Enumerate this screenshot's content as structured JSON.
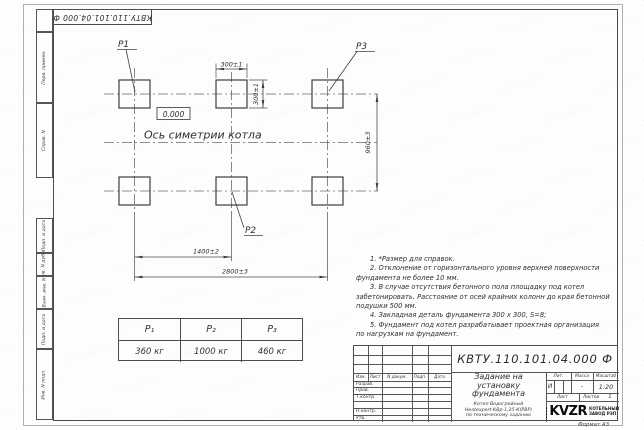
{
  "page": {
    "format_note": "Формат А3",
    "watermark_text": "··············"
  },
  "frame": {
    "top_stamp": "КВТУ.110.101.04.000  Ф",
    "left_margin_labels": [
      "Перв. примен.",
      "Справ. N",
      "Подп. и дата",
      "Инв. N дубл.",
      "Взам. инв. N",
      "Подп. и дата",
      "Инв. N подл."
    ]
  },
  "plan": {
    "pad_labels": {
      "p1": "P1",
      "p2": "P2",
      "p3": "P3"
    },
    "elevation_mark": "0.000",
    "axis_caption": "Ось симетрии котла",
    "dims": {
      "pad_width": "300±1",
      "pad_height": "300±1",
      "row_pitch": "960±3",
      "mid_pitch": "1400±2",
      "full_pitch": "2800±3"
    }
  },
  "load_table": {
    "headers": [
      "P₁",
      "P₂",
      "P₃"
    ],
    "values": [
      "360 кг",
      "1000 кг",
      "460 кг"
    ]
  },
  "notes": {
    "lines": [
      "1. *Размер для справок.",
      "2. Отклонение от горизонтального уровня верхней поверхности",
      "фундамента не более 10 мм.",
      "3. В случае отсутствия бетонного пола площадку под котел",
      "забетонировать. Расстояние от осей крайних колонн до края бетонной",
      "подушки 500 мм.",
      "4. Закладная деталь фундамента  300 x 300, S=8;",
      "5. Фундамент под котел разрабатывает проектная организация",
      "по нагрузкам на фундамент."
    ]
  },
  "title_block": {
    "designation": "КВТУ.110.101.04.000  Ф",
    "doc_title_lines": [
      "Задание на",
      "установку",
      "фундамента"
    ],
    "product_lines": [
      "Котел Водогрейный",
      "Heatexpert-КВр-1,25-К(РВР)",
      "по техническому заданию"
    ],
    "rev_headers": [
      "Изм.",
      "Лист",
      "N докум.",
      "Подп.",
      "Дата"
    ],
    "signature_rows": [
      "Разраб.",
      "Пров.",
      "Т.контр.",
      "",
      "Н.контр.",
      "Утв."
    ],
    "lit_label": "Лит.",
    "mass_label": "Масса",
    "scale_label": "Масштаб",
    "lit_value": "И",
    "mass_value": "-",
    "scale_value": "1:20",
    "sheet_label": "Лист",
    "sheets_label": "Листов",
    "sheets_count": "1",
    "logo_text": "KVZR",
    "company_lines": [
      "КОТЕЛЬНЫЙ",
      "ЗАВОД РЭП"
    ]
  },
  "colors": {
    "line": "#4c4c4c",
    "text": "#2e2e2e",
    "watermark": "#8296b4"
  }
}
